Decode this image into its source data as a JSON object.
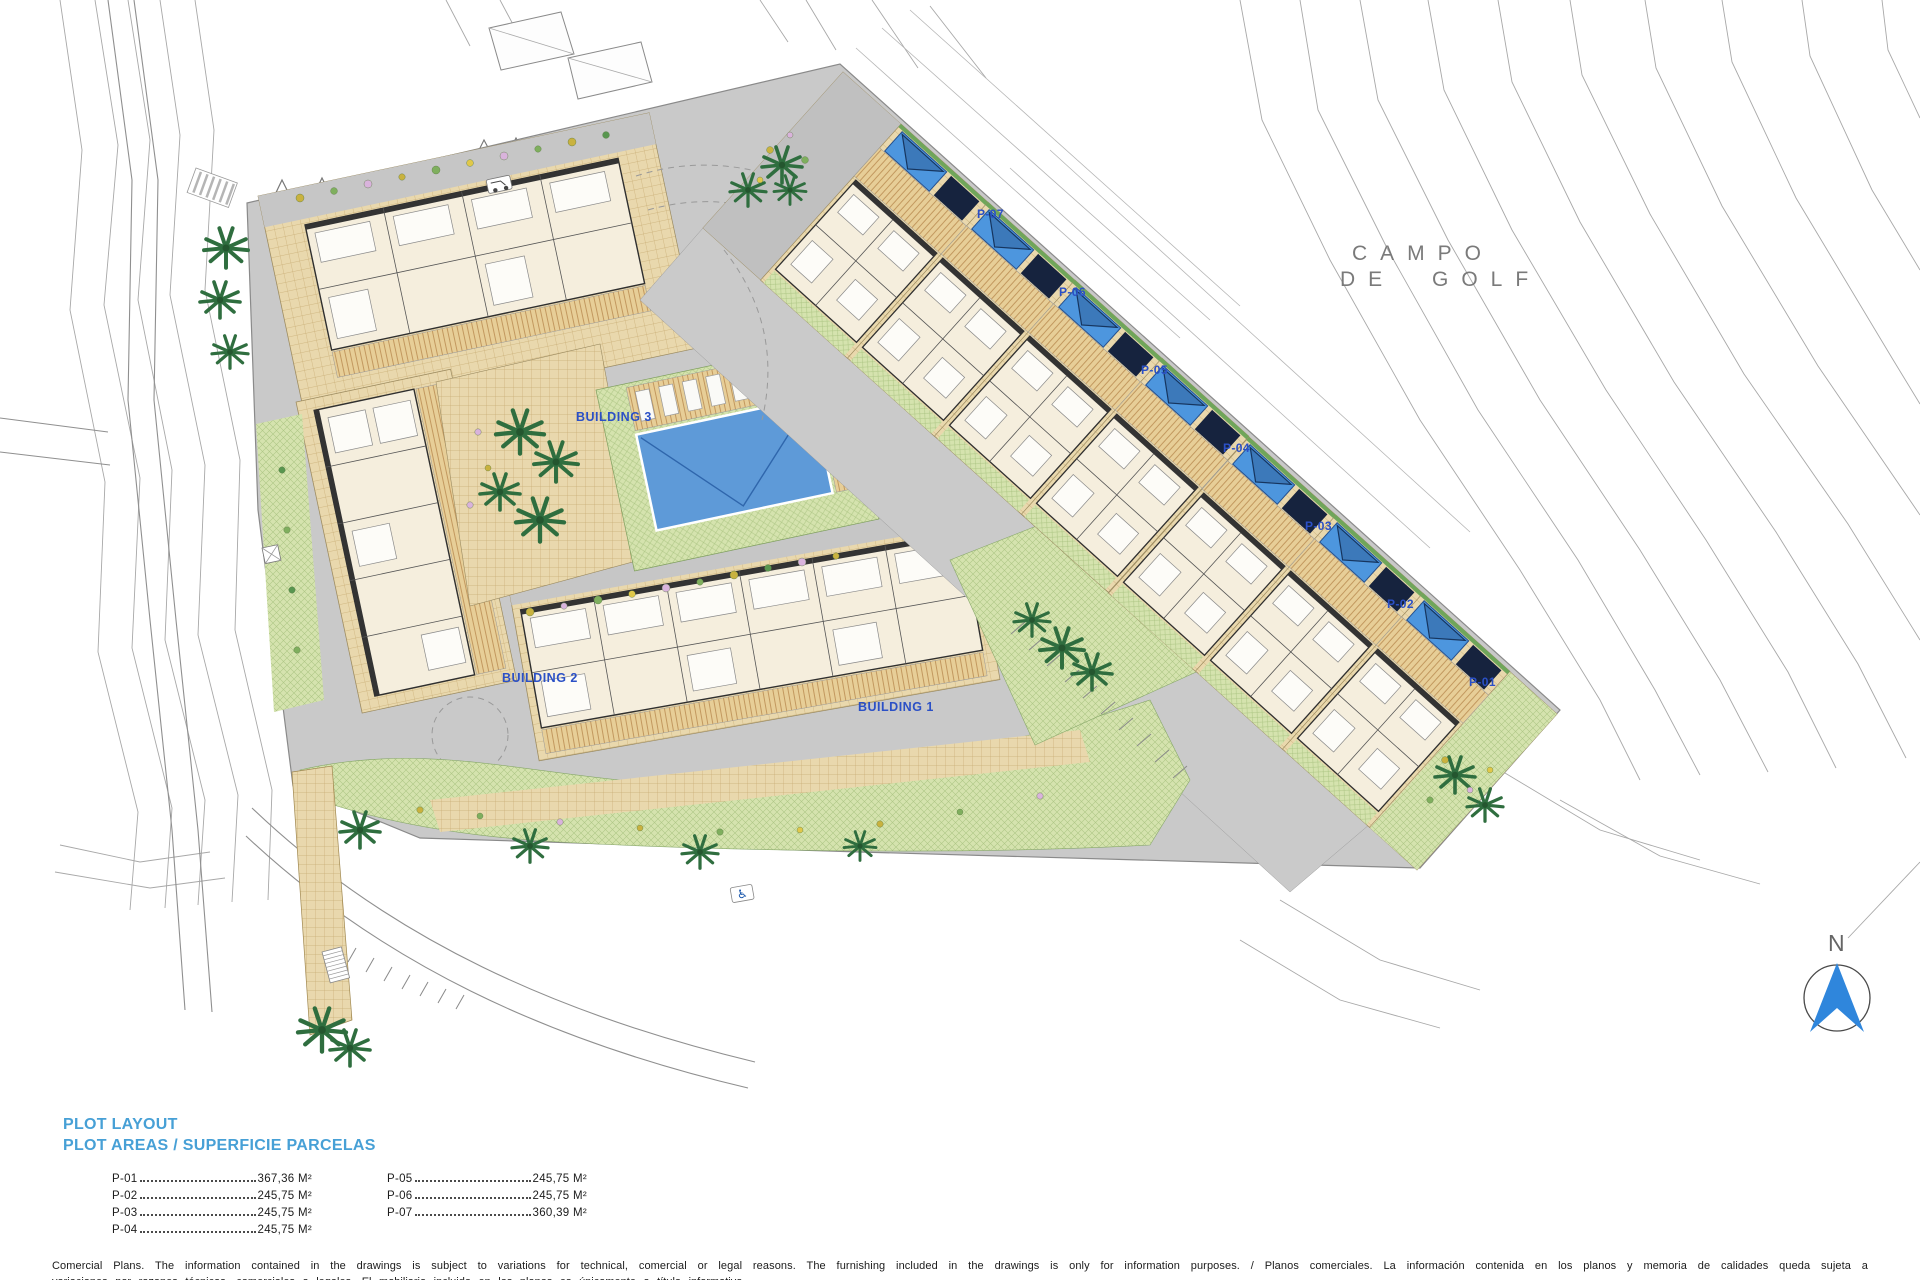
{
  "plan": {
    "building_labels": [
      {
        "label": "BUILDING 1"
      },
      {
        "label": "BUILDING 2"
      },
      {
        "label": "BUILDING 3"
      }
    ],
    "plot_labels": [
      {
        "label": "P-07"
      },
      {
        "label": "P-06"
      },
      {
        "label": "P-05"
      },
      {
        "label": "P-04"
      },
      {
        "label": "P-03"
      },
      {
        "label": "P-02"
      },
      {
        "label": "P-01"
      }
    ],
    "golf_course": {
      "line1": "CAMPO",
      "line2": "DE GOLF"
    },
    "north_label": "N",
    "icons": {
      "accessible_parking": "♿"
    }
  },
  "legend": {
    "title": "PLOT LAYOUT",
    "subtitle": "PLOT AREAS / SUPERFICIE PARCELAS",
    "columns": [
      {
        "items": [
          {
            "id": "P-01",
            "area": "367,36 M²"
          },
          {
            "id": "P-02",
            "area": "245,75 M²"
          },
          {
            "id": "P-03",
            "area": "245,75 M²"
          },
          {
            "id": "P-04",
            "area": "245,75 M²"
          }
        ]
      },
      {
        "items": [
          {
            "id": "P-05",
            "area": "245,75 M²"
          },
          {
            "id": "P-06",
            "area": "245,75 M²"
          },
          {
            "id": "P-07",
            "area": "360,39 M²"
          }
        ]
      }
    ]
  },
  "footer": {
    "line1": "Comercial Plans. The information contained in the drawings is subject to variations for technical, comercial or legal reasons. The furnishing included in the drawings is only for information purposes. / Planos comerciales. La información contenida en los planos y memoria de calidades queda sujeta a",
    "line2": "variaciones por razones técnicas, comerciales o legales. El mobiliario incluido en los planos es únicamente a título informativo."
  },
  "colors": {
    "legend_blue": "#47A0D6",
    "label_blue": "#2B50C6",
    "pool_blue": "#5E9AD8",
    "paving_tan": "#E9D8AD",
    "lawn_green": "#D5E3AE"
  }
}
